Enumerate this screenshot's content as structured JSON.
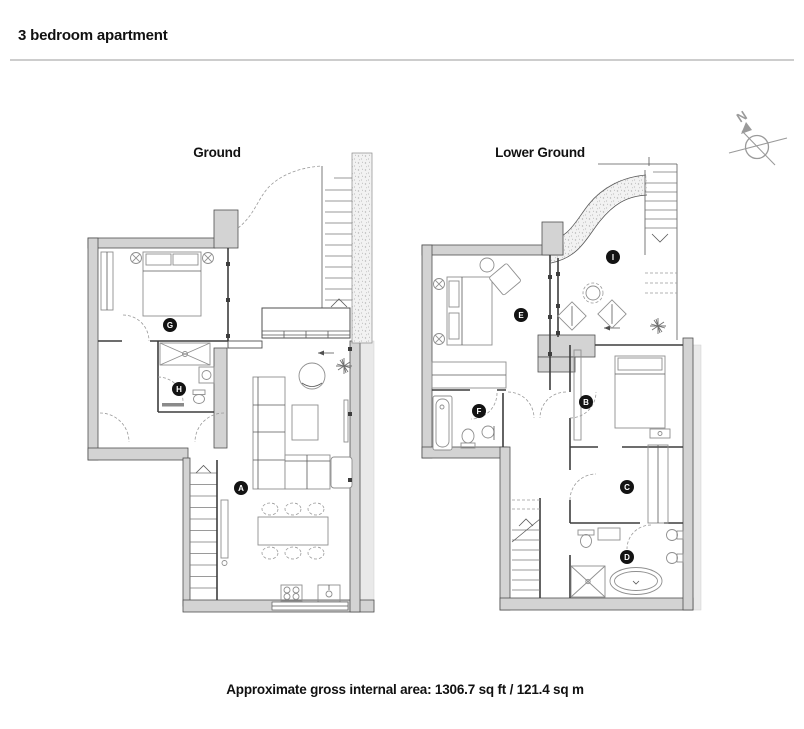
{
  "header": {
    "title": "3 bedroom apartment"
  },
  "plans": [
    {
      "name": "Ground",
      "room_labels": [
        {
          "letter": "G"
        },
        {
          "letter": "H"
        },
        {
          "letter": "A"
        }
      ]
    },
    {
      "name": "Lower Ground",
      "room_labels": [
        {
          "letter": "E"
        },
        {
          "letter": "I"
        },
        {
          "letter": "F"
        },
        {
          "letter": "B"
        },
        {
          "letter": "C"
        },
        {
          "letter": "D"
        }
      ]
    }
  ],
  "compass": {
    "north_label": "N"
  },
  "footer": {
    "area_text": "Approximate gross internal area: 1306.7 sq ft / 121.4 sq m"
  },
  "colors": {
    "wall_fill": "#d3d3d3",
    "wall_light": "#e9e9e9",
    "label_bg": "#131313",
    "label_text": "#ffffff",
    "compass": "#9a9a9a",
    "line": "#4f4f4f"
  }
}
